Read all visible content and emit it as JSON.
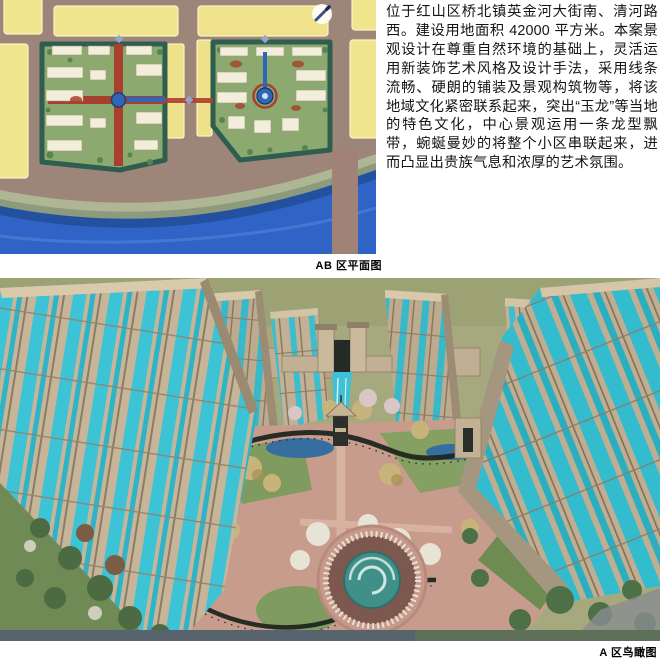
{
  "description": {
    "text": "位于红山区桥北镇英金河大街南、清河路西。建设用地面积 42000 平方米。本案景观设计在尊重自然环境的基础上，灵活运用新装饰艺术风格及设计手法，采用线条流畅、硬朗的铺装及景观构筑物等，将该地域文化紧密联系起来，突出“玉龙”等当地的特色文化，中心景观运用一条龙型飘带，蜿蜒曼妙的将整个小区串联起来，进而凸显出贵族气息和浓厚的艺术氛围。",
    "site_area_sqm": "42000"
  },
  "figures": {
    "site_plan": {
      "caption": "AB 区平面图",
      "type": "colored master-plan drawing",
      "elements": [
        "yellow land parcels",
        "roads",
        "parcel B with red cross axis and blue pond",
        "parcel A with blue keyhole water feature",
        "river along south edge",
        "road bridge over river",
        "compass-pencil icon"
      ]
    },
    "aerial_view": {
      "caption": "A 区鸟瞰图",
      "type": "bird's-eye 3D rendering",
      "elements": [
        "tan towers with cyan glass stripes",
        "entrance gate with water cascade",
        "dark dragon ribbon pergola",
        "central pavilion",
        "circular fountain plaza",
        "lawns and trees"
      ]
    }
  },
  "palette": {
    "road": "#9e8579",
    "parcel_yellow": "#f1e58d",
    "parcel_green": "#8ca96f",
    "parcel_border": "#2d5e50",
    "axis_red": "#a8402e",
    "water_blue": "#2f64c6",
    "river_dark": "#23509f",
    "tower_tan": "#c6b598",
    "glass_cyan": "#3cc3d5",
    "grass_olive": "#a6a97e",
    "path_pink": "#c79c8d",
    "ribbon_dark": "#20261f",
    "fountain_teal": "#418f89"
  }
}
